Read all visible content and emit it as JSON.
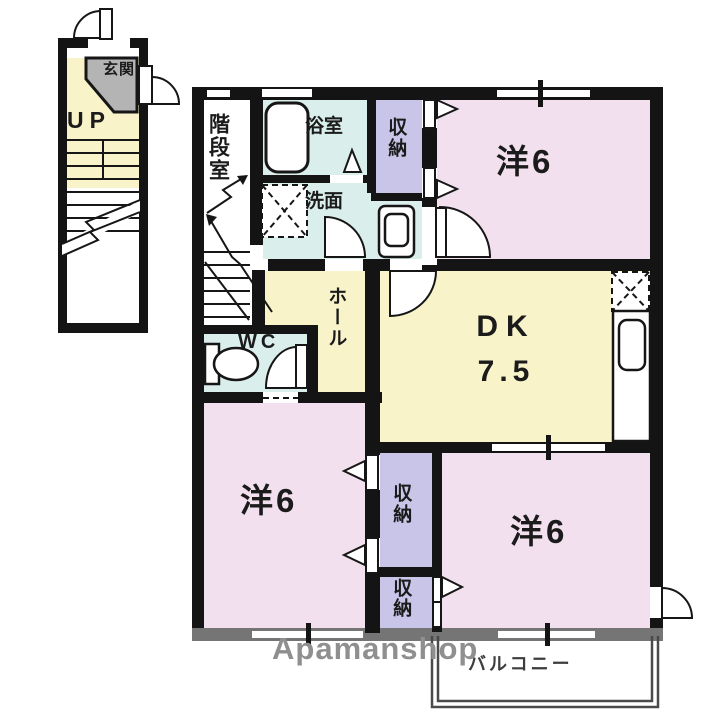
{
  "watermark": "Apamanshop",
  "labels": {
    "entrance": "玄関",
    "up": "UP",
    "stairwell": "階段室",
    "bath": "浴室",
    "washroom": "洗面",
    "storage_top": "収納",
    "storage_mid": "収納",
    "storage_bottom": "収納",
    "hall": "ホール",
    "wc": "WC",
    "dk": "DK",
    "dk_size": "7.5",
    "western_top": "洋6",
    "western_left": "洋6",
    "western_right": "洋6",
    "balcony": "バルコニー"
  },
  "colors": {
    "wall": "#141414",
    "wall_bottom": "#757575",
    "pink": "#f3e0ee",
    "yellow": "#f8f3c8",
    "cyan": "#daefeb",
    "purple": "#c9c5e8",
    "gray_area": "#b4b4b4",
    "balcony_line": "#4a4a4a",
    "watermark": "#8f8f8f"
  }
}
